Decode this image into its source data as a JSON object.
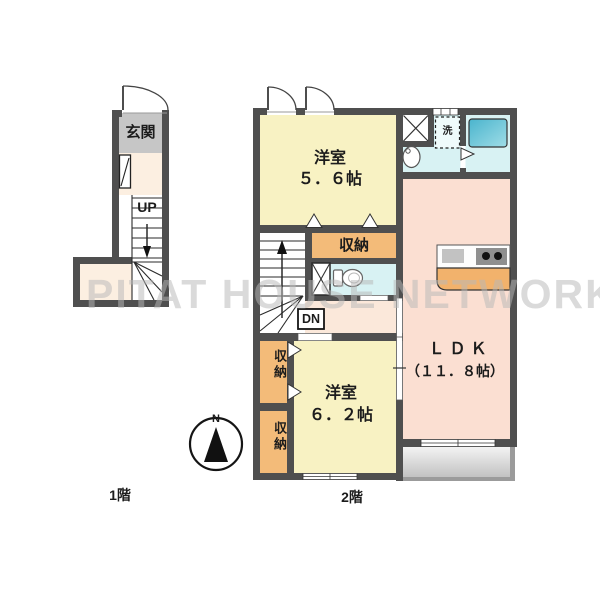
{
  "watermark": "PITAT HOUSE NETWORK",
  "floor1": {
    "label": "1階",
    "entrance_label": "玄関",
    "stairs_up_label": "UP"
  },
  "floor2": {
    "label": "2階",
    "bedroom_top": {
      "name": "洋室",
      "size": "５．６帖"
    },
    "bedroom_bottom": {
      "name": "洋室",
      "size": "６．２帖"
    },
    "ldk": {
      "name": "ＬＤＫ",
      "size": "（１１．８帖）"
    },
    "storage_hall_label": "収納",
    "storage_upper_label": "収納",
    "storage_lower_label": "収納",
    "washer_label": "洗",
    "stairs_down_label": "DN"
  },
  "compass": {
    "north_label": "N"
  },
  "colors": {
    "wall": "#4f4f4f",
    "room_yellow": "#f8f2c3",
    "ldk_pink": "#fbdfd2",
    "storage_orange": "#f3bb79",
    "sanitary_cyan": "#d8f2f3",
    "bathtub_teal": "#55bcd2",
    "entrance_gray": "#c6c6c6",
    "hall_cream": "#fcefe1",
    "kitchen_counter_orange": "#f2b26c",
    "balcony_gray": "#c6c6c6"
  }
}
